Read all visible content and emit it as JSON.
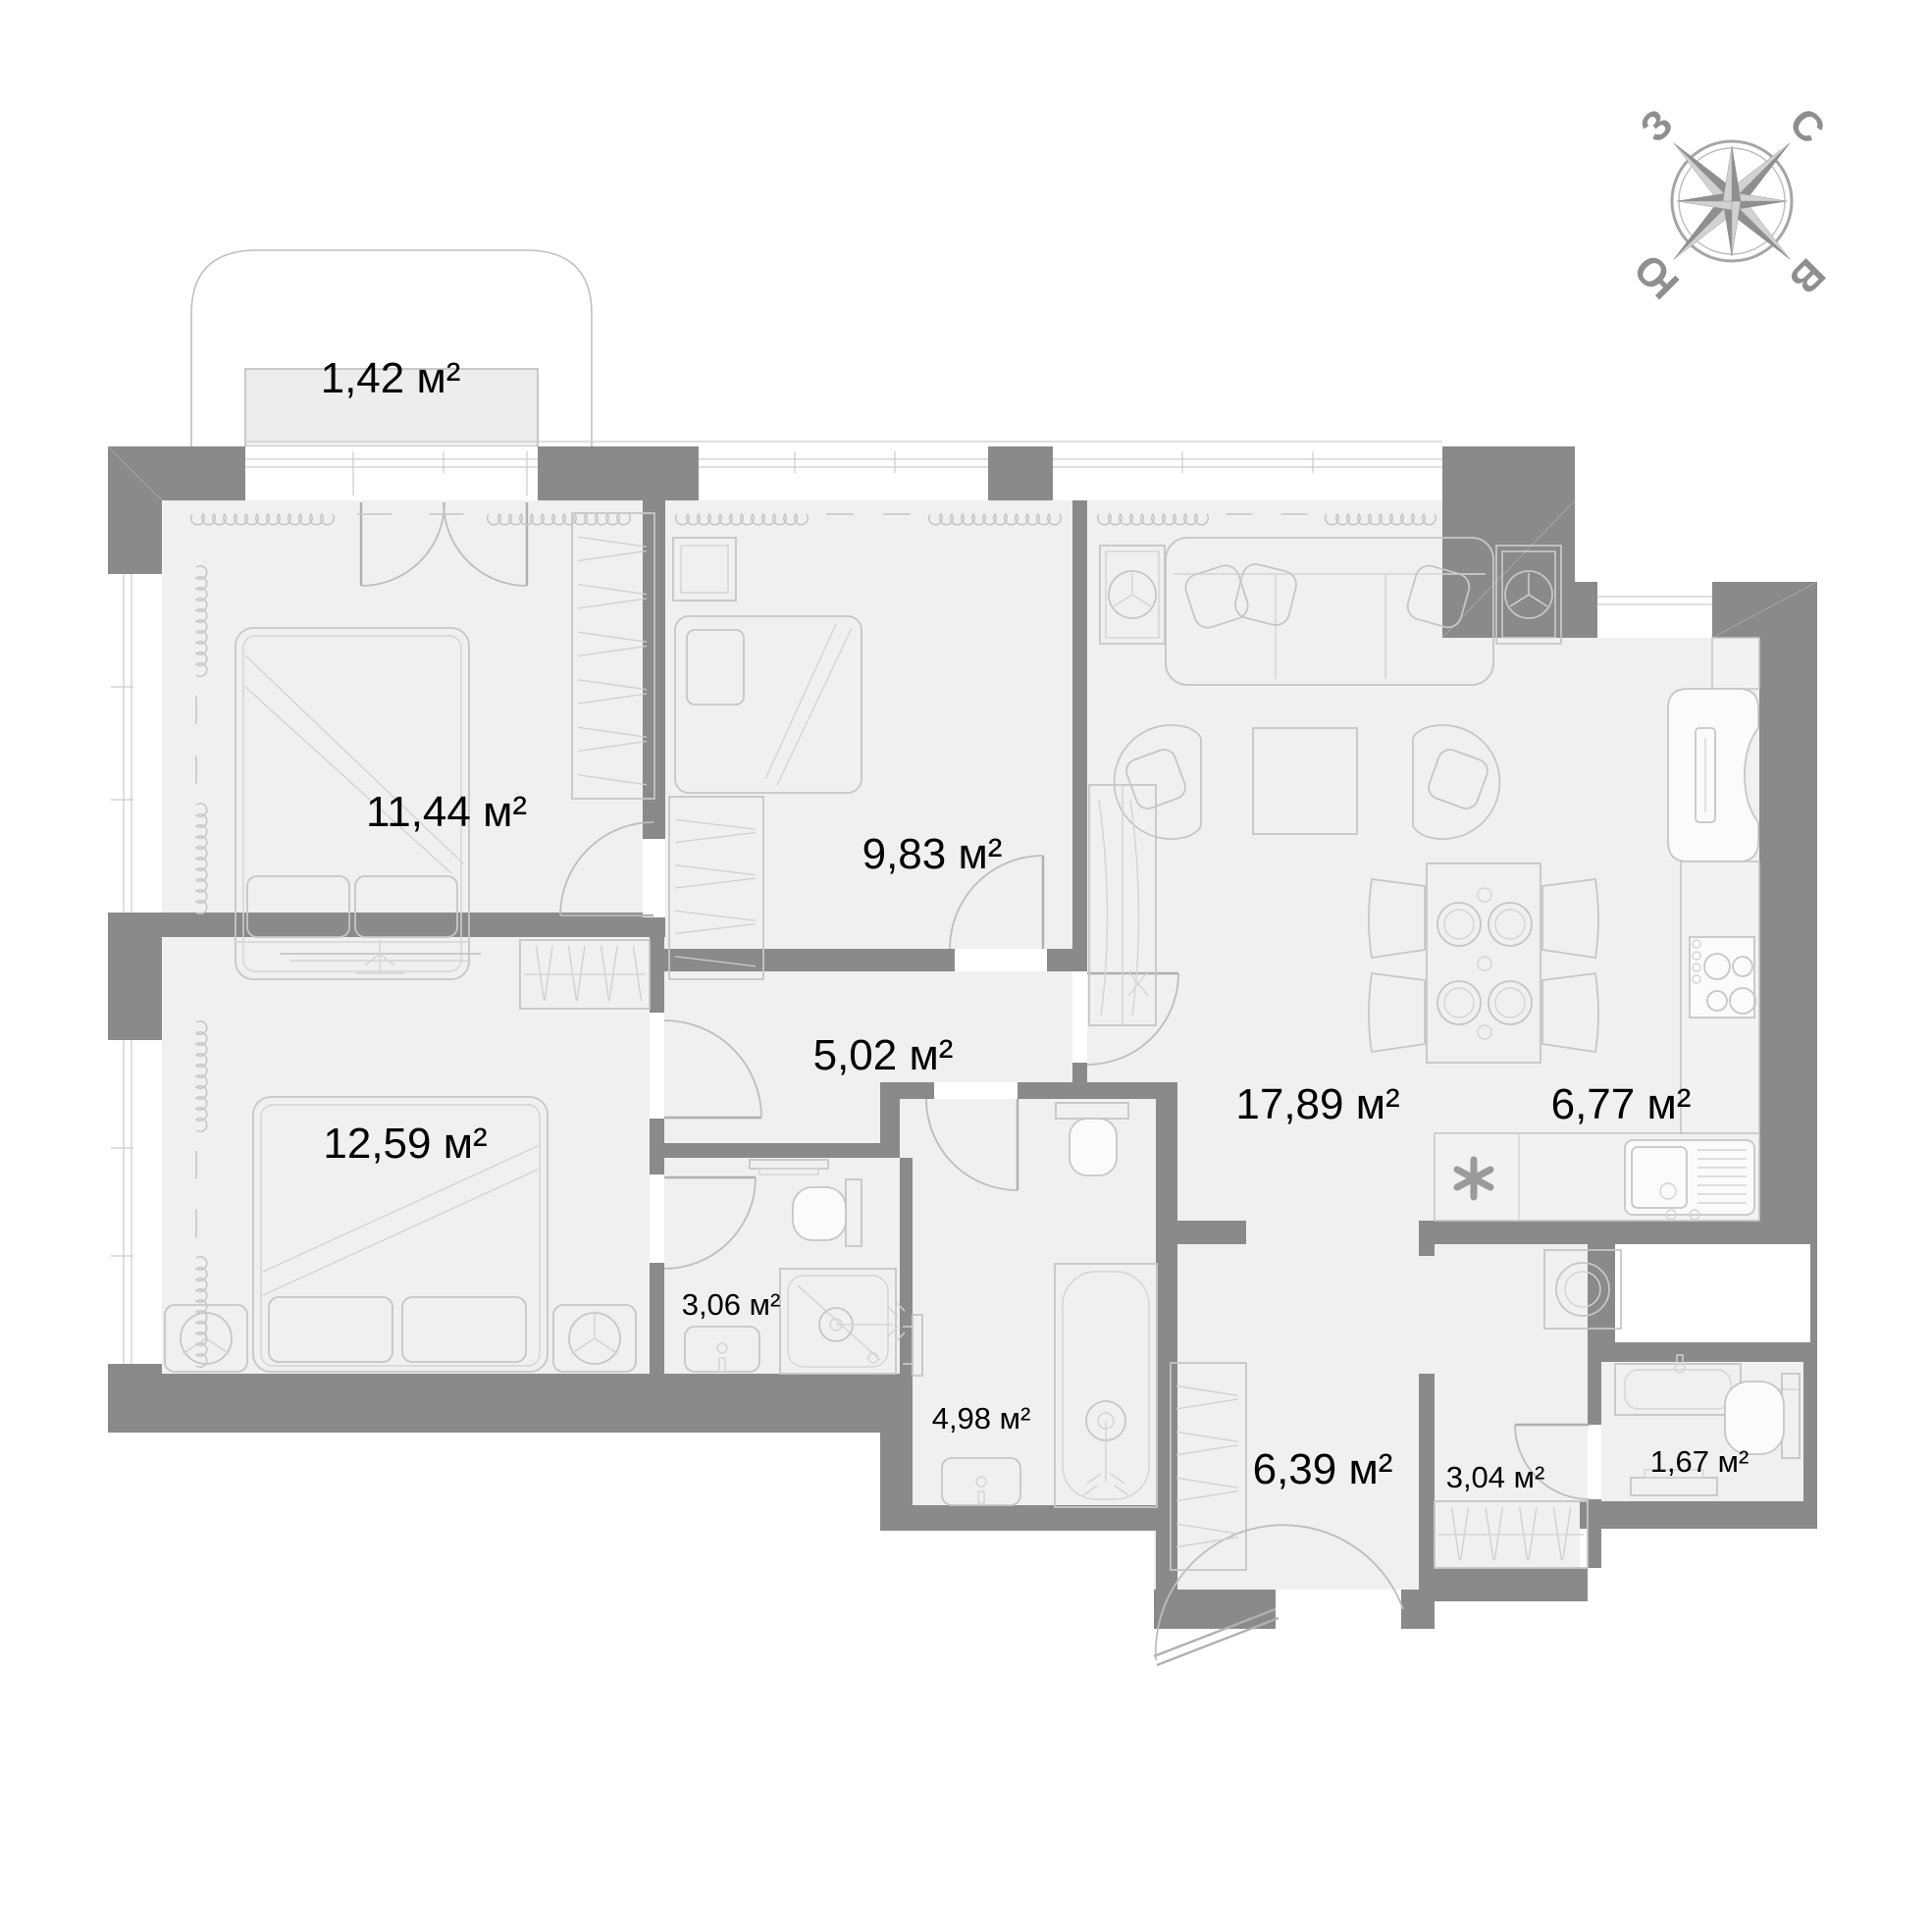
{
  "compass": {
    "north": "С",
    "south": "Ю",
    "west": "З",
    "east": "В"
  },
  "rooms": [
    {
      "id": "balcony",
      "label": "1,42 м²"
    },
    {
      "id": "bedroom-1",
      "label": "11,44 м²"
    },
    {
      "id": "bedroom-2",
      "label": "9,83 м²"
    },
    {
      "id": "hallway",
      "label": "5,02 м²"
    },
    {
      "id": "living-room",
      "label": "17,89 м²"
    },
    {
      "id": "kitchen",
      "label": "6,77 м²"
    },
    {
      "id": "bedroom-3",
      "label": "12,59 м²"
    },
    {
      "id": "shower-room",
      "label": "3,06 м²"
    },
    {
      "id": "bathroom",
      "label": "4,98 м²"
    },
    {
      "id": "entrance-hall",
      "label": "6,39 м²"
    },
    {
      "id": "laundry",
      "label": "3,04 м²"
    },
    {
      "id": "wc",
      "label": "1,67 м²"
    }
  ]
}
